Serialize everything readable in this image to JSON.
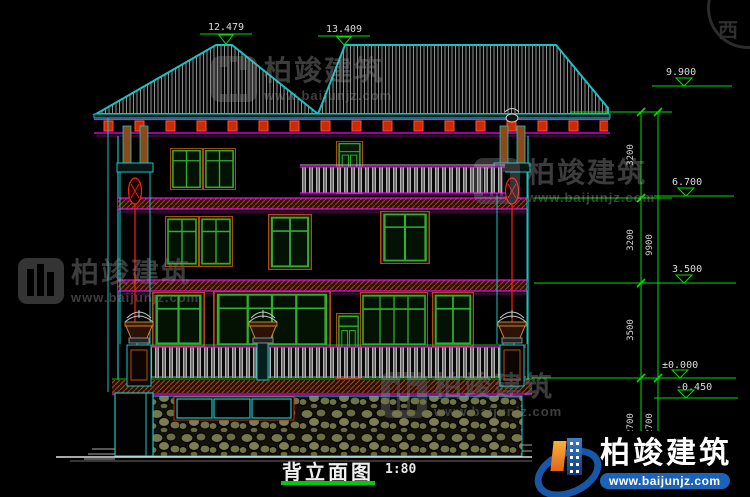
{
  "drawing": {
    "title": "背立面图",
    "scale": "1:80",
    "ridge_left": "12.479",
    "ridge_right": "13.409",
    "elev_eave": "9.900",
    "elev_f3": "6.700",
    "elev_f2": "3.500",
    "elev_f1": "±0.000",
    "elev_grade": "-0.450",
    "dim_1": "3200",
    "dim_2": "3200",
    "dim_3": "3500",
    "dim_4": "2700",
    "dim_total": "9900",
    "dim_basement": "2700"
  },
  "watermark": {
    "brand": "柏竣建筑",
    "url": "www.baijunjz.com",
    "compass": "西"
  },
  "logo": {
    "brand": "柏竣建筑",
    "url": "www.baijunjz.com"
  },
  "colors": {
    "background": "#000000",
    "roof_edge": "#19c2c2",
    "dimension_green": "#00dd00",
    "accent_magenta": "#ff00ff",
    "accent_red": "#ff2200",
    "window_green": "#2fae2f",
    "logo_blue": "#1b63b8",
    "logo_orange": "#f9b23c"
  }
}
